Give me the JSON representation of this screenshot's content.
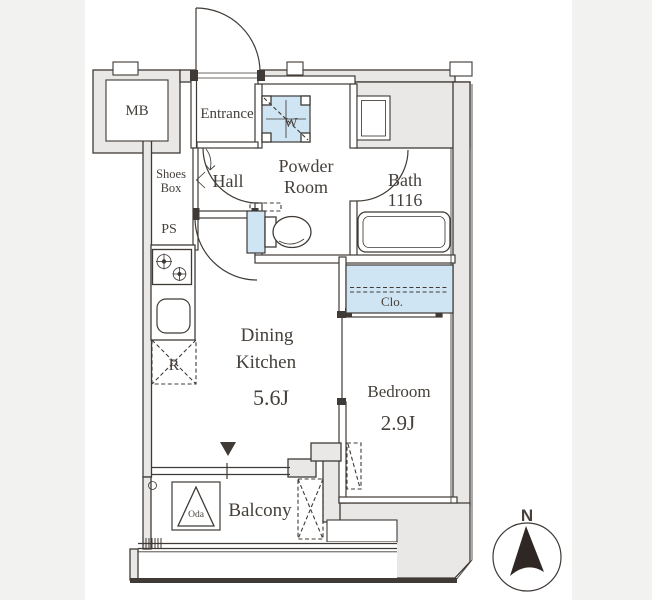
{
  "floorplan": {
    "rooms": {
      "mb": "MB",
      "entrance": "Entrance",
      "shoes_box": [
        "Shoes",
        "Box"
      ],
      "hall": "Hall",
      "ps": "PS",
      "powder_room": [
        "Powder",
        "Room"
      ],
      "bath": "Bath",
      "bath_size": "1116",
      "dining_kitchen": [
        "Dining",
        "Kitchen"
      ],
      "dining_area": "5.6J",
      "closet": "Clo.",
      "bedroom": "Bedroom",
      "bedroom_area": "2.9J",
      "balcony": "Balcony"
    },
    "fixtures": {
      "washer_label": "W",
      "fridge_label": "R",
      "hatch_label": "Oda"
    },
    "compass": {
      "north": "N"
    },
    "colors": {
      "background": "#f2f2f1",
      "sheet": "#ffffff",
      "wall": "#e9e8e6",
      "line": "#3f3a36",
      "highlight": "#cfe5f4",
      "ink": "#45403b",
      "arrow": "#2e2723"
    }
  }
}
